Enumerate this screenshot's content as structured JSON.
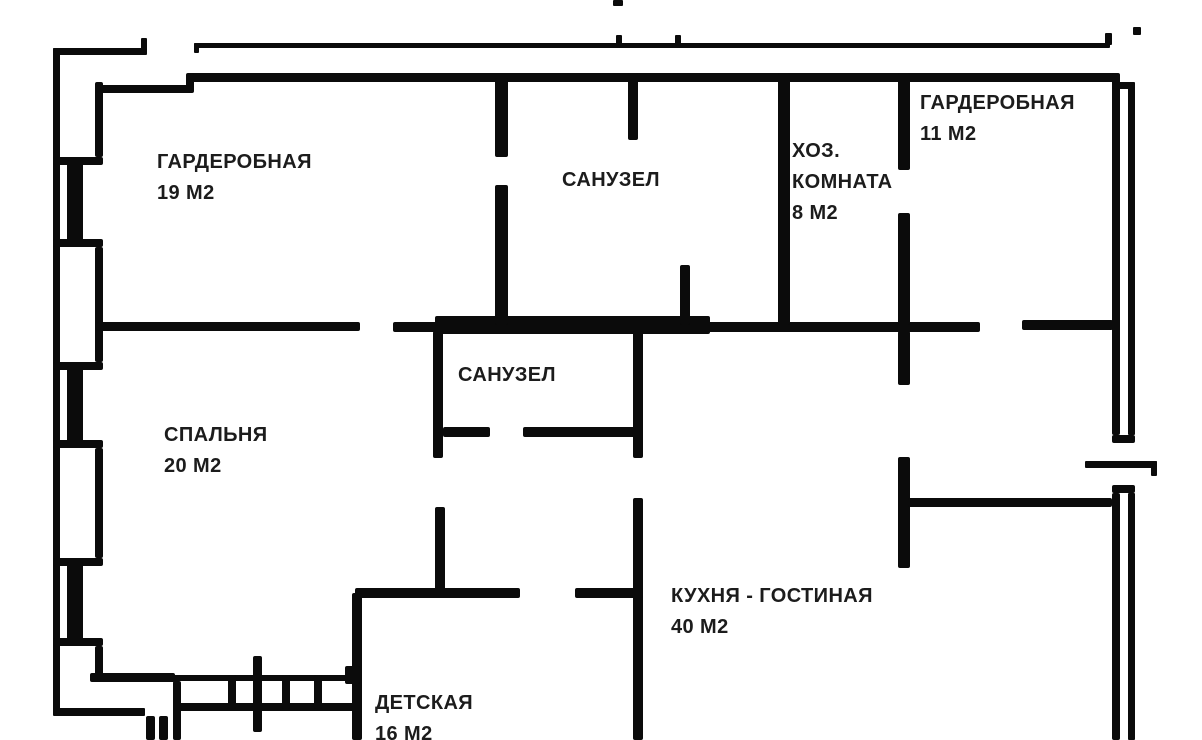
{
  "meta": {
    "kind": "apartment-floor-plan",
    "language": "ru"
  },
  "colors": {
    "bg": "#ffffff",
    "wall": "#0b0b0b",
    "text": "#1c1c1c"
  },
  "rooms": [
    {
      "id": "wardrobe-19",
      "name": "ГАРДЕРОБНАЯ",
      "area": "19 М2"
    },
    {
      "id": "bathroom-top",
      "name": "САНУЗЕЛ"
    },
    {
      "id": "utility-room",
      "line1": "ХОЗ.",
      "line2": "КОМНАТА",
      "area": "8 М2"
    },
    {
      "id": "wardrobe-11",
      "name": "ГАРДЕРОБНАЯ",
      "area": "11 М2"
    },
    {
      "id": "bedroom",
      "name": "СПАЛЬНЯ",
      "area": "20 М2"
    },
    {
      "id": "bathroom-mid",
      "name": "САНУЗЕЛ"
    },
    {
      "id": "kitchen-living",
      "name": "КУХНЯ - ГОСТИНАЯ",
      "area": "40 М2"
    },
    {
      "id": "nursery",
      "name": "ДЕТСКАЯ",
      "area": "16 М2"
    }
  ]
}
